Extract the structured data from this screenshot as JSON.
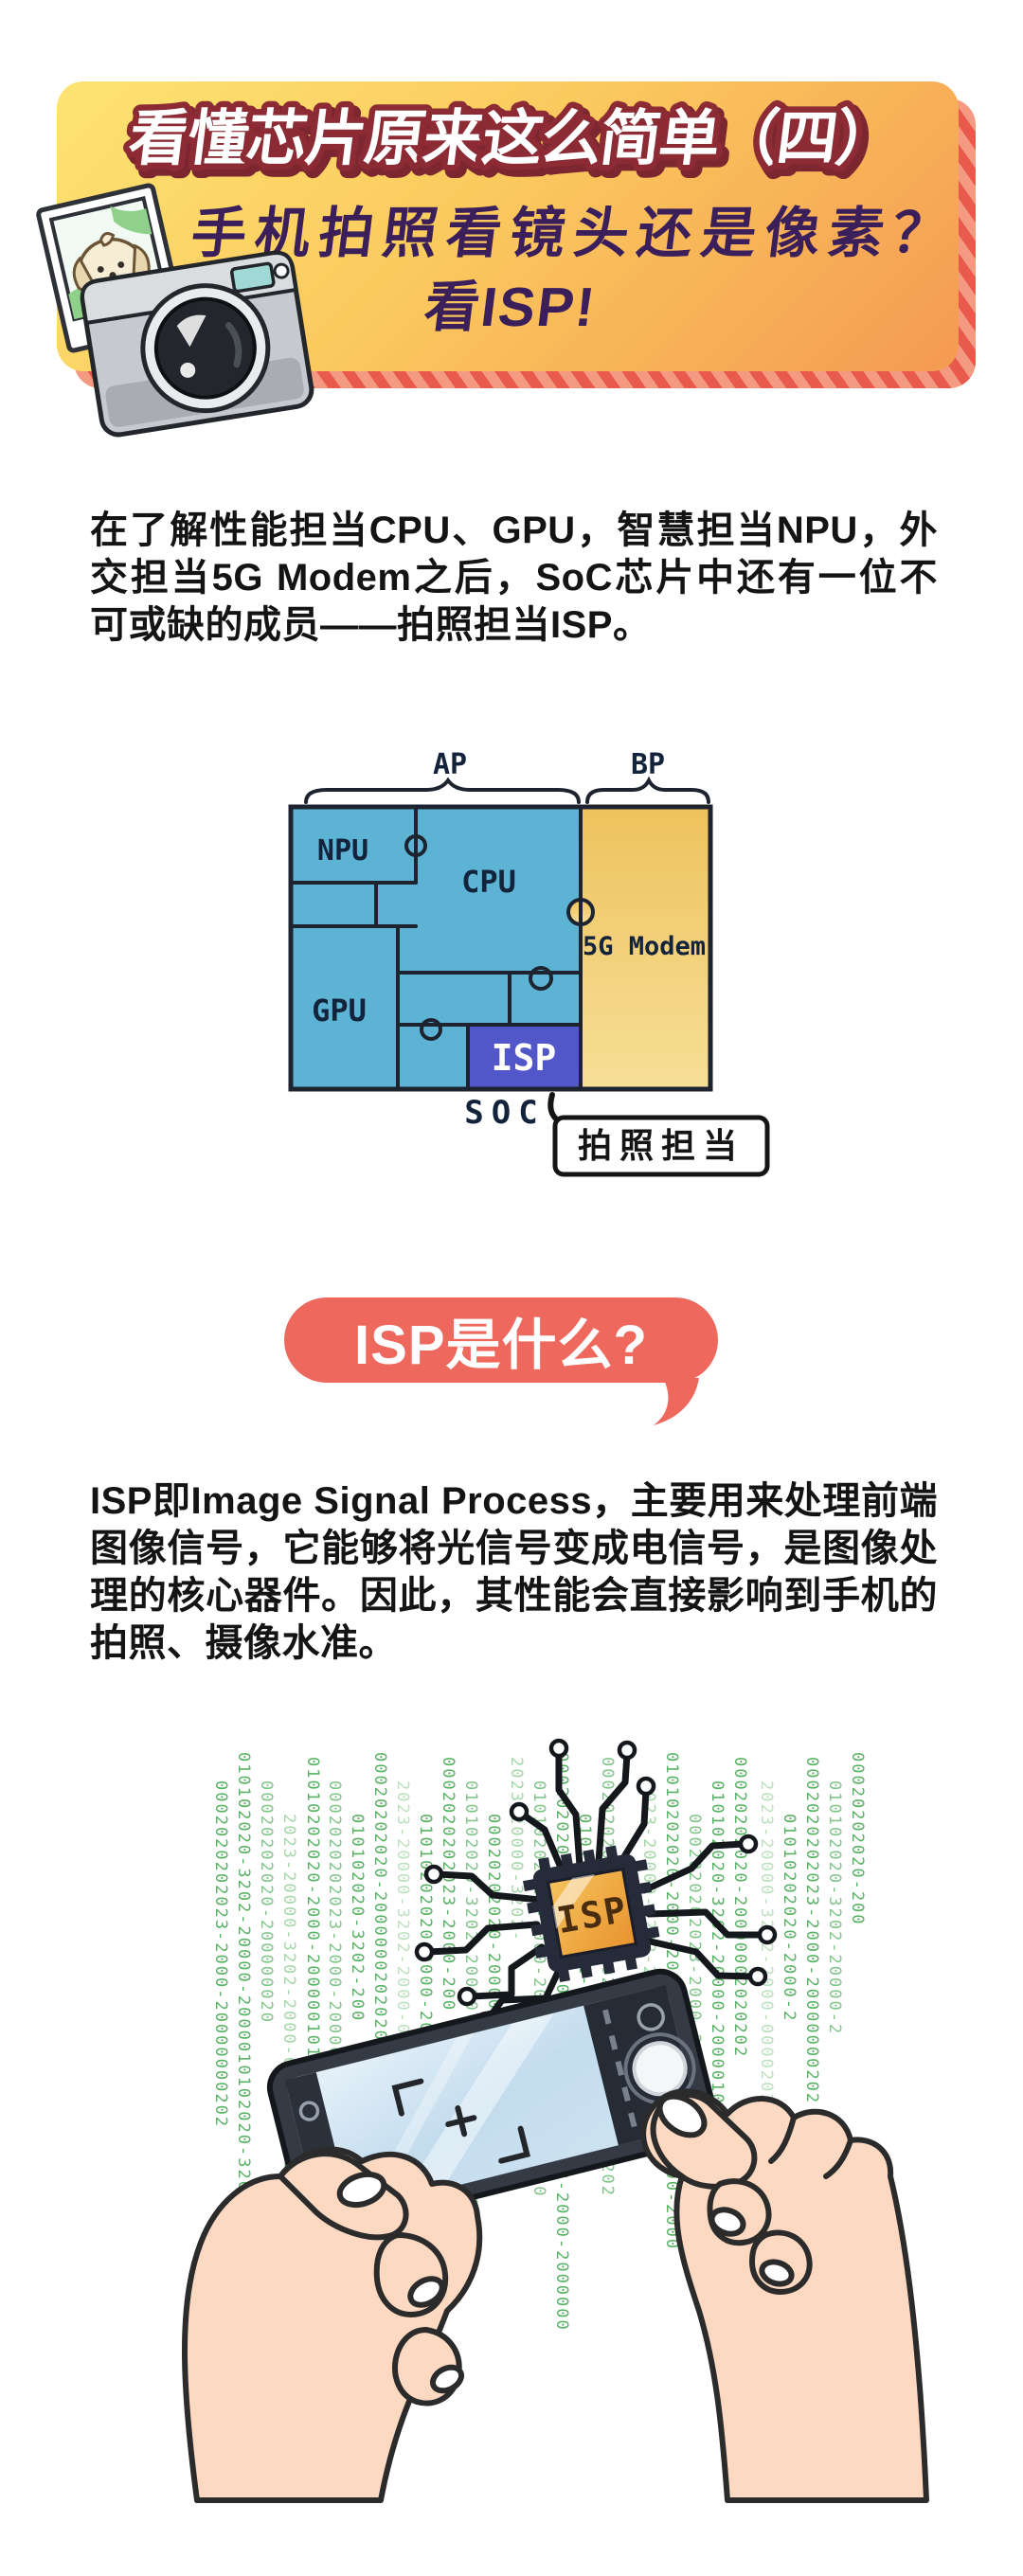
{
  "header": {
    "title": "看懂芯片原来这么简单（四）",
    "subtitle1": "手机拍照看镜头还是像素？",
    "subtitle2": "看ISP!",
    "colors": {
      "card_top": "#fde472",
      "card_bottom": "#f49a52",
      "stripe_dark": "#e85a4b",
      "stripe_light": "#f59a82",
      "title_fill": "#ffffff",
      "title_stroke": "#8d2b35",
      "subtitle_color": "#3a1f5a"
    }
  },
  "intro_paragraph": "在了解性能担当CPU、GPU，智慧担当NPU，外交担当5G Modem之后，SoC芯片中还有一位不可或缺的成员——拍照担当ISP。",
  "soc_diagram": {
    "ap_label": "AP",
    "bp_label": "BP",
    "npu_label": "NPU",
    "cpu_label": "CPU",
    "gpu_label": "GPU",
    "isp_label": "ISP",
    "modem_label": "5G Modem",
    "soc_label": "SOC",
    "callout_label": "拍照担当",
    "colors": {
      "blue": "#5cb3d4",
      "yellow_top": "#eec25d",
      "yellow_bottom": "#f7df97",
      "isp_purple": "#5156c8",
      "line": "#1d2430"
    }
  },
  "question_bubble": {
    "text": "ISP是什么?",
    "bg": "#ee685d"
  },
  "body_paragraph": "ISP即Image Signal Process，主要用来处理前端图像信号，它能够将光信号变成电信号，是图像处理的核心器件。因此，其性能会直接影响到手机的拍照、摄像水准。",
  "illustration": {
    "chip_label": "ISP",
    "matrix_columns": [
      "0002020202023-2000-20000",
      "010102020-3202-20000-2000",
      "00020202020-2000",
      "2023-20000-3202-2000-0000",
      "01010202020-2000-20000"
    ],
    "colors": {
      "matrix_green": "#58b264",
      "matrix_green_light": "#a5d7a8",
      "chip_orange": "#f0a437",
      "chip_frame": "#262b3a",
      "skin": "#fdd9c2",
      "outline": "#2b2b2b"
    }
  }
}
